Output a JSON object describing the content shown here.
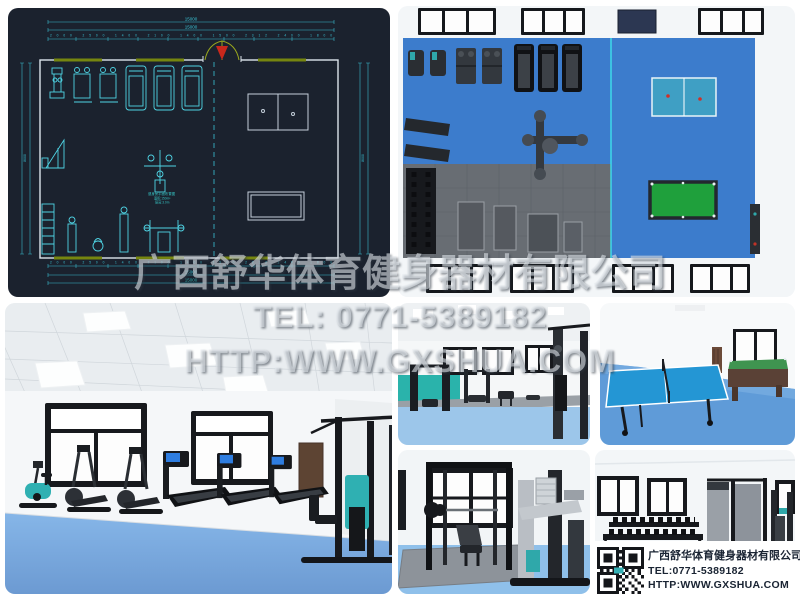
{
  "watermark": {
    "company": "广西舒华体育健身器材有限公司",
    "tel": "TEL: 0771-5389182",
    "url": "HTTP:WWW.GXSHUA.COM"
  },
  "info_box": {
    "company": "广西舒华体育健身器材有限公司",
    "tel": "TEL:0771-5389182",
    "url": "HTTP:WWW.GXSHUA.COM",
    "qr_icon": "qr-code"
  },
  "cad_plan": {
    "dim_total_a": "15000",
    "dim_total_b": "15000",
    "dims_top_row": "2000 2500 1400 2100 1400 1500 2312 2400 1800",
    "dims_bottom_row": "2000 2500 1400 2100 1400 1500 2312 2400 1800",
    "dim_bottom_a": "15000",
    "dim_bottom_b": "15000",
    "dim_left": "8000",
    "dim_right": "8000",
    "caption1": "健身房平面布置图",
    "caption2": "面积:150m²",
    "caption3": "层高:3.0m"
  },
  "colors": {
    "cad_background": "#1b222e",
    "cad_line_cyan": "#4fd4e4",
    "cad_wall": "#dce4ec",
    "cad_window_olive": "#76860f",
    "cad_door_red": "#c9281c",
    "floor_blue_topdown": "#3c7ccc",
    "floor_blue_room": "#7fb2e6",
    "mat_gray": "#686d73",
    "pingpong_blue": "#2496d4",
    "billiard_green": "#1fa03c",
    "teal_accent": "#2fb0b2",
    "info_text": "#1a2433"
  }
}
